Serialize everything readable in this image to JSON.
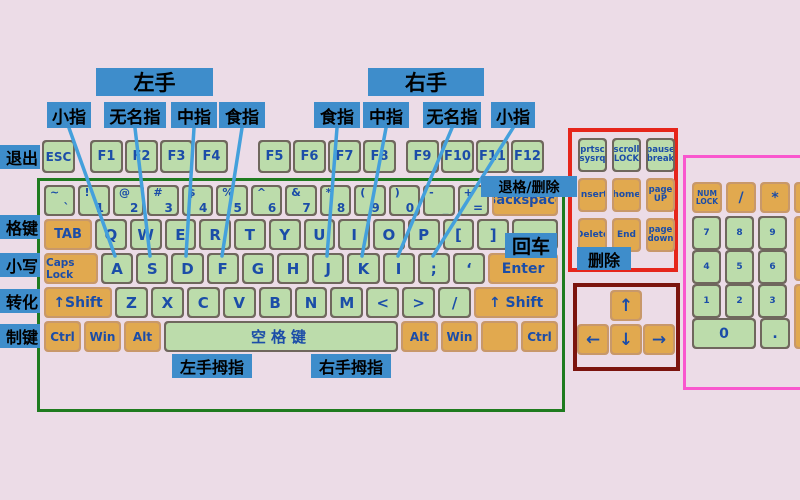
{
  "hands": {
    "left": "左手",
    "right": "右手"
  },
  "fingers": {
    "left": [
      "小指",
      "无名指",
      "中指",
      "食指"
    ],
    "right": [
      "食指",
      "中指",
      "无名指",
      "小指"
    ]
  },
  "side_labels": [
    "退出",
    "格键",
    "小写",
    "转化",
    "制键"
  ],
  "notes": {
    "backspace": "退格/删除",
    "enter": "回车",
    "delete": "删除",
    "left_thumb": "左手拇指",
    "right_thumb": "右手拇指"
  },
  "function_row": {
    "esc": "ESC",
    "groups": [
      [
        "F1",
        "F2",
        "F3",
        "F4"
      ],
      [
        "F5",
        "F6",
        "F7",
        "F8"
      ],
      [
        "F9",
        "F10",
        "F11",
        "F12"
      ]
    ]
  },
  "main_rows": {
    "numbers": [
      [
        "~",
        "`"
      ],
      [
        "!",
        "1"
      ],
      [
        "@",
        "2"
      ],
      [
        "#",
        "3"
      ],
      [
        "$",
        "4"
      ],
      [
        "%",
        "5"
      ],
      [
        "^",
        "6"
      ],
      [
        "&",
        "7"
      ],
      [
        "*",
        "8"
      ],
      [
        "(",
        "9"
      ],
      [
        ")",
        "0"
      ],
      [
        "-",
        "_"
      ],
      [
        "+",
        "="
      ]
    ],
    "backspace": "Backspace",
    "tab": "TAB",
    "qwerty": [
      "Q",
      "W",
      "E",
      "R",
      "T",
      "Y",
      "U",
      "I",
      "O",
      "P",
      "[",
      "]",
      ""
    ],
    "caps": "Caps Lock",
    "home": [
      "A",
      "S",
      "D",
      "F",
      "G",
      "H",
      "J",
      "K",
      "I",
      ";",
      "‘"
    ],
    "enter": "Enter",
    "shift_left": "↑Shift",
    "zrow": [
      "Z",
      "X",
      "C",
      "V",
      "B",
      "N",
      "M",
      "<",
      ">",
      "/"
    ],
    "shift_right": "↑ Shift",
    "bottom_left": [
      "Ctrl",
      "Win",
      "Alt"
    ],
    "space": "空格键",
    "bottom_right": [
      "Alt",
      "Win",
      "",
      "Ctrl"
    ]
  },
  "nav_cluster": {
    "top": [
      [
        "prtsc",
        "sysrq"
      ],
      [
        "scroll",
        "LOCK"
      ],
      [
        "pause",
        "break"
      ]
    ],
    "mid": [
      "Insert",
      "home",
      [
        "page",
        "UP"
      ]
    ],
    "bot": [
      "Delete",
      "End",
      [
        "page",
        "down"
      ]
    ]
  },
  "arrows": {
    "up": "↑",
    "left": "←",
    "down": "↓",
    "right": "→"
  },
  "numpad": {
    "top": [
      [
        "NUM",
        "LOCK"
      ],
      "/",
      "*"
    ],
    "digits": [
      [
        "7",
        "8",
        "9"
      ],
      [
        "4",
        "5",
        "6"
      ],
      [
        "1",
        "2",
        "3"
      ]
    ],
    "zero": "0",
    "dot": "."
  },
  "colors": {
    "background": "#ecdce7",
    "label_bg": "#3e8dcb",
    "key_face_green": "#bcdcab",
    "key_face_orange": "#e1a94f",
    "key_plate": "#6f675d",
    "key_text": "#1b4da8",
    "board_border": "#1f7b1f",
    "nav_border": "#e6251b",
    "arrow_border": "#7b140e",
    "numpad_border": "#f957ce",
    "leader_line": "#44a0dc"
  }
}
